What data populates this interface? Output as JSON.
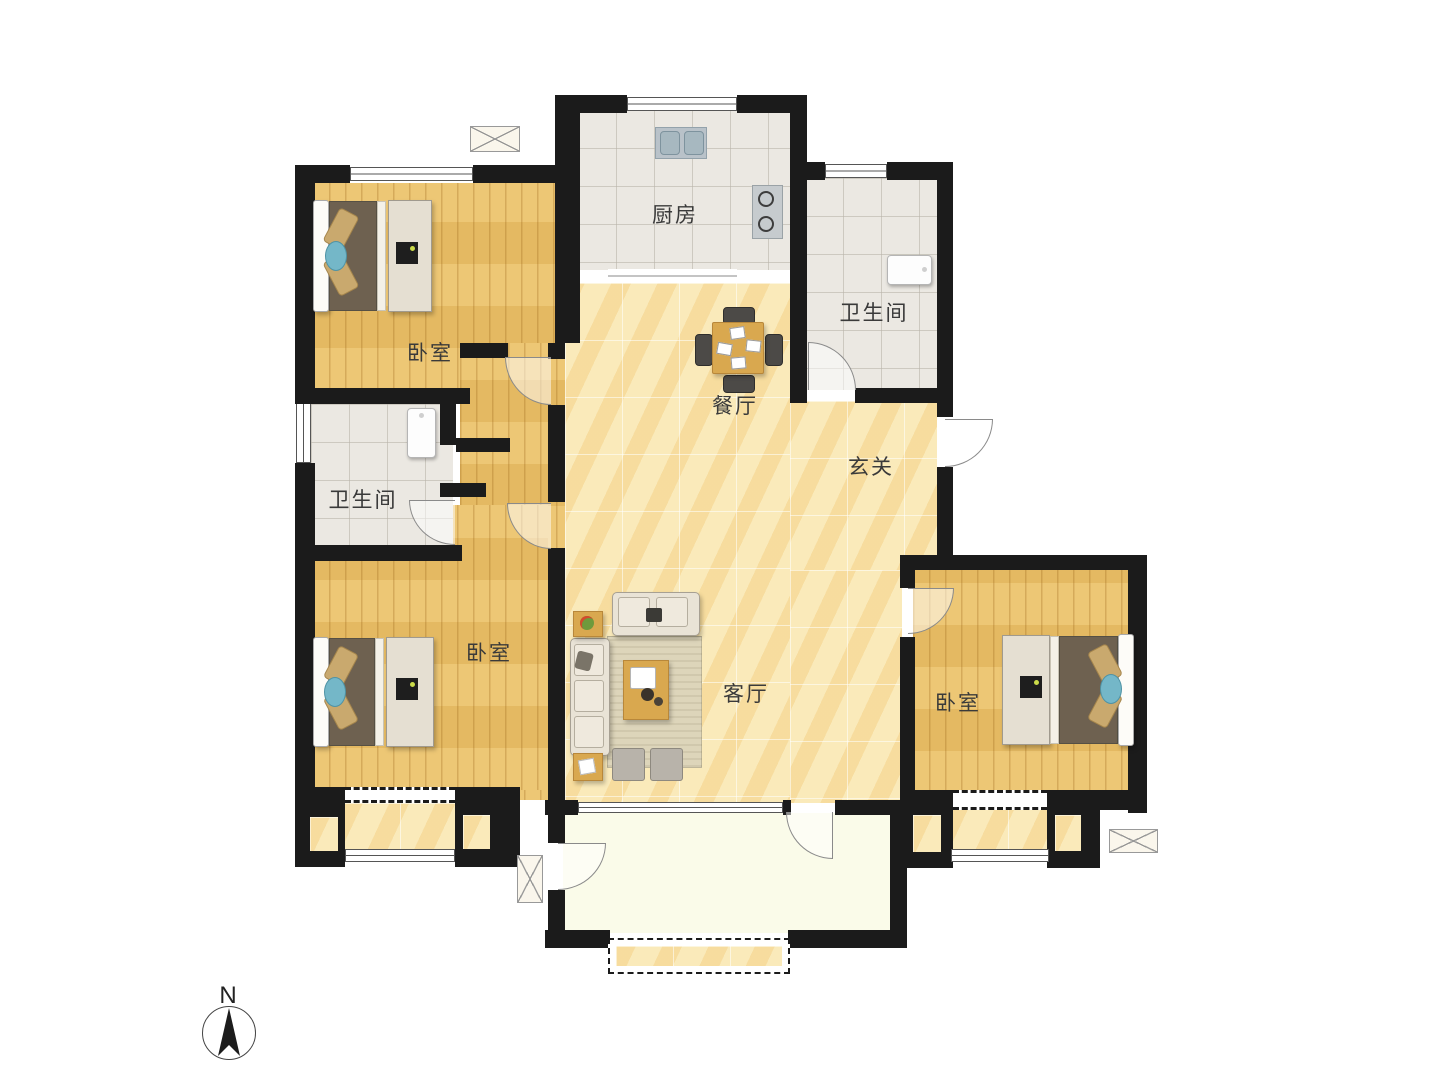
{
  "rooms": {
    "bedroom_a": "卧室",
    "bedroom_b": "卧室",
    "bedroom_c": "卧室",
    "kitchen": "厨房",
    "bathroom_a": "卫生间",
    "bathroom_b": "卫生间",
    "dining": "餐厅",
    "entry": "玄关",
    "living": "客厅"
  },
  "compass": {
    "north": "N"
  },
  "colors": {
    "wall": "#1b1b1b",
    "wood_floor": "#ecc269",
    "marble_floor": "#f8e6b2",
    "tile_floor": "#ebe8e2",
    "balcony_floor": "#fafbe9",
    "accent_blue": "#74b7c8",
    "furniture_wood": "#d9a84f",
    "duvet_brown": "#6e6150"
  }
}
